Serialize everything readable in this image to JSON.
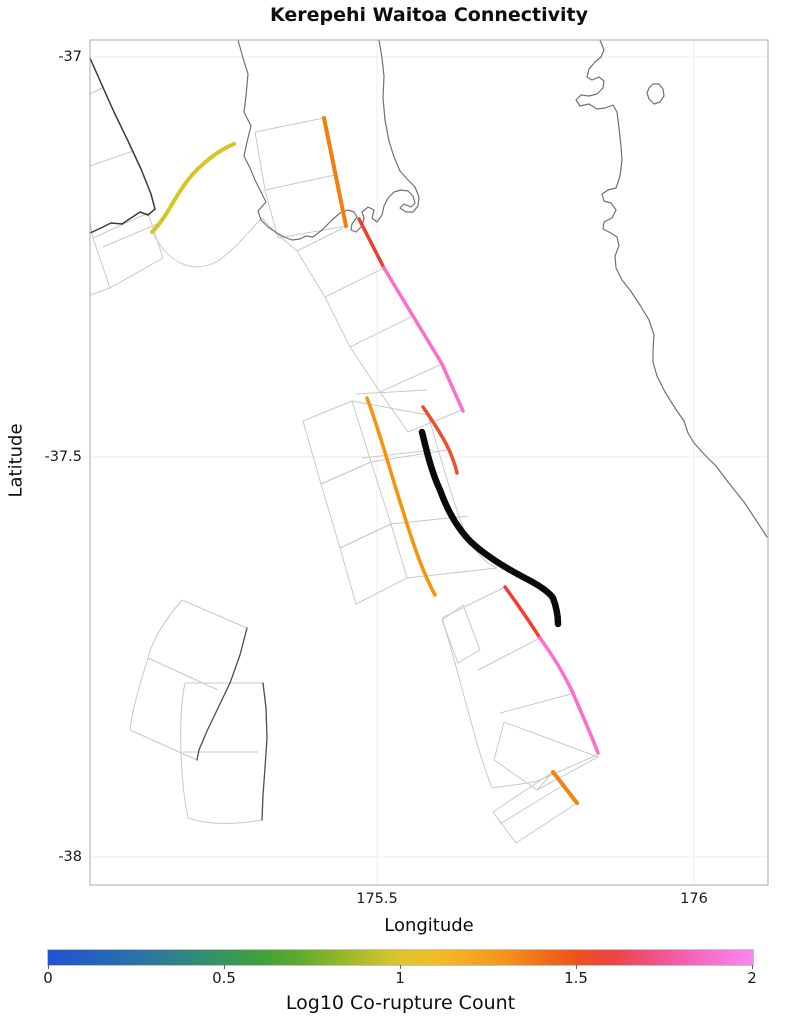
{
  "title": "Kerepehi Waitoa Connectivity",
  "axes": {
    "xlabel": "Longitude",
    "ylabel": "Latitude",
    "x_ticks": [
      {
        "label": "175.5",
        "px": 377
      },
      {
        "label": "176",
        "px": 694
      }
    ],
    "y_ticks": [
      {
        "label": "-37",
        "py": 57
      },
      {
        "label": "-37.5",
        "py": 457
      },
      {
        "label": "-38",
        "py": 857
      }
    ]
  },
  "colorbar": {
    "label": "Log10 Co-rupture Count",
    "range": [
      0,
      2
    ],
    "ticks": [
      {
        "label": "0",
        "pos": "0%"
      },
      {
        "label": "0.5",
        "pos": "25%"
      },
      {
        "label": "1",
        "pos": "50%"
      },
      {
        "label": "1.5",
        "pos": "75%"
      },
      {
        "label": "2",
        "pos": "100%"
      }
    ],
    "gradient": [
      {
        "pos": "0%",
        "color": "#2153d4"
      },
      {
        "pos": "7%",
        "color": "#2563bd"
      },
      {
        "pos": "14%",
        "color": "#2b77a0"
      },
      {
        "pos": "20%",
        "color": "#2f8880"
      },
      {
        "pos": "25%",
        "color": "#35975c"
      },
      {
        "pos": "30%",
        "color": "#3fa03c"
      },
      {
        "pos": "35%",
        "color": "#5aa92e"
      },
      {
        "pos": "40%",
        "color": "#87b32a"
      },
      {
        "pos": "45%",
        "color": "#b3bd2b"
      },
      {
        "pos": "50%",
        "color": "#ddc62e"
      },
      {
        "pos": "55%",
        "color": "#f2bc28"
      },
      {
        "pos": "60%",
        "color": "#f4a822"
      },
      {
        "pos": "65%",
        "color": "#f5921b"
      },
      {
        "pos": "70%",
        "color": "#f07018"
      },
      {
        "pos": "75%",
        "color": "#ec531d"
      },
      {
        "pos": "80%",
        "color": "#ed4342"
      },
      {
        "pos": "85%",
        "color": "#f04f7e"
      },
      {
        "pos": "90%",
        "color": "#f45fae"
      },
      {
        "pos": "95%",
        "color": "#f873d3"
      },
      {
        "pos": "100%",
        "color": "#fb87f2"
      }
    ]
  },
  "chart_data": {
    "type": "map",
    "title": "Kerepehi Waitoa Connectivity",
    "xlabel": "Longitude",
    "ylabel": "Latitude",
    "xlim": [
      175.05,
      176.12
    ],
    "ylim": [
      -38.03,
      -36.98
    ],
    "grid": true,
    "colorbar_label": "Log10 Co-rupture Count",
    "colorbar_range": [
      0,
      2
    ],
    "highlighted_fault": {
      "color": "#0a0a0a",
      "style": "thick black line (target Kerepehi Waitoa section)",
      "start_lonlat": [
        175.571,
        -37.469
      ],
      "end_lonlat": [
        175.786,
        -37.709
      ]
    },
    "fault_traces": [
      {
        "color": "#d6c525",
        "approx_log10_corupture": 1.0,
        "start_lonlat": [
          175.145,
          -37.219
        ],
        "end_lonlat": [
          175.274,
          -37.109
        ]
      },
      {
        "color": "#f57d0e",
        "approx_log10_corupture": 1.3,
        "start_lonlat": [
          175.416,
          -37.076
        ],
        "end_lonlat": [
          175.451,
          -37.211
        ]
      },
      {
        "color": "#f23d28",
        "approx_log10_corupture": 1.55,
        "start_lonlat": [
          175.472,
          -37.203
        ],
        "end_lonlat": [
          175.511,
          -37.264
        ]
      },
      {
        "color": "#fa6fce",
        "approx_log10_corupture": 1.85,
        "start_lonlat": [
          175.511,
          -37.264
        ],
        "end_lonlat": [
          175.636,
          -37.443
        ]
      },
      {
        "color": "#f89307",
        "approx_log10_corupture": 1.25,
        "start_lonlat": [
          175.484,
          -37.426
        ],
        "end_lonlat": [
          175.591,
          -37.673
        ]
      },
      {
        "color": "#ea512b",
        "approx_log10_corupture": 1.5,
        "start_lonlat": [
          175.573,
          -37.438
        ],
        "end_lonlat": [
          175.626,
          -37.52
        ]
      },
      {
        "color": "#f23d30",
        "approx_log10_corupture": 1.55,
        "start_lonlat": [
          175.702,
          -37.663
        ],
        "end_lonlat": [
          175.757,
          -37.726
        ]
      },
      {
        "color": "#fa6fce",
        "approx_log10_corupture": 1.85,
        "start_lonlat": [
          175.757,
          -37.726
        ],
        "end_lonlat": [
          175.849,
          -37.87
        ]
      },
      {
        "color": "#f5820a",
        "approx_log10_corupture": 1.3,
        "start_lonlat": [
          175.778,
          -37.894
        ],
        "end_lonlat": [
          175.815,
          -37.933
        ]
      }
    ],
    "background": "light-gray fault-section polygon mesh, dark-gray unselected fault traces, Firth of Thames / Hauraki coastline"
  },
  "map": {
    "frame": {
      "x": 90,
      "y": 40,
      "w": 678,
      "h": 845
    },
    "frame_color": "#a9a9a9",
    "grid_color": "#ececec",
    "layers": [
      {
        "name": "fault-polygon-mesh",
        "stroke": "#c9c9c9",
        "width": 1,
        "cap": "butt",
        "paths": [
          "M90,94 L104,87",
          "M90,166 L133,151",
          "M90,222 L93,238",
          "M93,238 L148,213 L163,258 L110,288 Z",
          "M103,247 L157,224",
          "M90,295 L110,288",
          "M153,233 C170,268 200,275 222,258 C238,246 250,230 262,218",
          "M262,218 C272,230 284,240 297,251",
          "M255,132 L324,118",
          "M255,132 L265,190 L278,238",
          "M265,190 L335,175",
          "M278,238 L346,226",
          "M297,251 L325,297 L350,347 L380,392 L408,432",
          "M297,251 L343,228",
          "M325,297 L384,268",
          "M350,347 L413,316",
          "M380,392 L442,364",
          "M408,432 L462,410",
          "M303,421 L352,401 L371,462 L321,484 Z",
          "M321,484 L371,462 L391,524 L340,548 Z",
          "M340,548 L391,524 L407,578 L356,604 Z",
          "M352,401 L428,415",
          "M356,394 L427,390",
          "M362,458 L433,450",
          "M428,415 C440,455 452,500 466,535 C475,552 485,563 497,568",
          "M371,462 L447,450",
          "M391,524 L468,516",
          "M407,578 L497,568",
          "M442,620 L463,605 L480,650 L458,663 Z",
          "M442,618 C452,650 462,690 472,725 C478,748 485,770 492,788",
          "M442,618 L503,588",
          "M478,670 L540,638",
          "M500,713 L571,694",
          "M535,782 L597,755",
          "M492,788 L535,782",
          "M504,722 L598,757 L537,790 L494,760 Z",
          "M537,790 L553,772",
          "M493,812 L553,772 L577,803 L516,843 Z",
          "M500,824 L562,786",
          "M182,600 L247,628",
          "M182,600 C165,620 152,640 148,658",
          "M148,658 L218,690",
          "M148,658 C138,690 132,712 130,730",
          "M130,730 L197,760",
          "M185,683 C178,715 180,780 188,818",
          "M185,683 L263,683",
          "M183,752 L258,752",
          "M188,818 C212,826 238,824 262,820"
        ]
      },
      {
        "name": "dark-fault-trace-west",
        "stroke": "#3a3a3a",
        "width": 1.5,
        "cap": "round",
        "paths": [
          "M90,58 L101,83 L114,112 L128,141 L141,169 L151,194 L155,209",
          "M155,209 L148,215 L140,212 L131,218 L122,224 L111,223 L101,228 L90,233"
        ]
      },
      {
        "name": "dark-fault-trace-southwest",
        "stroke": "#4d4d4d",
        "width": 1.3,
        "cap": "round",
        "paths": [
          "M247,628 L240,655 L230,683 L218,708 L207,731 L199,750 L197,760",
          "M263,683 L266,708 L267,738 L265,768 L263,795 L262,820"
        ]
      },
      {
        "name": "coastline",
        "stroke": "#707070",
        "width": 1.2,
        "cap": "round",
        "paths": [
          "M238,40 L243,58 L248,74 L246,96 L244,112 L251,126 L247,142 L244,156 L250,168 L255,180 L261,192 L266,202 L258,211 L261,220 L268,227 L277,233 L284,237 L292,240 L300,239 L306,236 L313,237 L322,230 L331,221 L340,213 L348,210 L354,212 L357,217 L352,224 L351,230 L356,232 L362,226 L364,218 L362,212 L368,207 L374,210 L372,218 L377,222 L382,215 L384,206 L388,198 L394,192 L401,190 L408,191 L413,196 L415,203 L411,207 L404,204 L400,208 L406,212 L413,212 L418,206 L419,197 L415,187 L408,180 L400,171 L394,157 L389,141 L385,120 L383,98 L384,76 L382,58 L379,40",
          "M600,40 L604,50 L601,57 L595,62 L589,69 L587,77 L592,80 L599,77 L604,81 L603,88 L597,94 L589,96 L581,95 L576,100 L580,106 L589,104 L597,109 L605,108 L613,105 L617,112 L619,128 L621,146 L622,160 L620,176 L616,188 L608,190 L602,194 L604,201 L611,203 L616,210 L612,218 L604,222 L603,229 L611,233 L617,237 L619,246 L615,256 L616,268 L622,280 L630,290 L640,305 L649,320 L654,335 L653,350 L653,362 L657,376 L665,392 L675,408 L684,421 L688,433 L694,443 L704,454 L716,466 L728,482 L744,502 L756,520 L767,537",
          "M649,88 L653,84 L659,84 L663,89 L664,96 L660,102 L654,104 L649,99 L647,93 Z"
        ]
      },
      {
        "name": "trace-yellow",
        "stroke": "#d6c525",
        "width": 4,
        "cap": "round",
        "paths": [
          "M152,232 C158,226 164,218 171,206 C179,192 189,176 201,166 C213,155 224,148 234,144"
        ]
      },
      {
        "name": "trace-orange-north",
        "stroke": "#f57d0e",
        "width": 4,
        "cap": "round",
        "paths": [
          "M324,118 L346,226"
        ]
      },
      {
        "name": "trace-red-north",
        "stroke": "#f23d28",
        "width": 3.5,
        "cap": "round",
        "paths": [
          "M359,219 L384,268"
        ]
      },
      {
        "name": "trace-pink-north",
        "stroke": "#fa6fce",
        "width": 3.5,
        "cap": "round",
        "paths": [
          "M384,268 L413,316 L442,364 L463,411"
        ]
      },
      {
        "name": "trace-orange-mid",
        "stroke": "#f89307",
        "width": 3.5,
        "cap": "round",
        "paths": [
          "M367,398 C380,432 392,478 403,511 C412,541 424,575 435,595"
        ]
      },
      {
        "name": "trace-redorange-mid",
        "stroke": "#ea512b",
        "width": 3.5,
        "cap": "round",
        "paths": [
          "M423,407 C432,420 444,438 450,452 C454,462 456,468 457,473"
        ]
      },
      {
        "name": "trace-black-waitoa",
        "stroke": "#0a0a0a",
        "width": 6.5,
        "cap": "round",
        "paths": [
          "M422,432 C426,448 431,471 440,490 C448,512 459,530 471,542 C486,556 506,568 523,577 C539,585 549,592 553,598 C556,606 558,614 558,624"
        ]
      },
      {
        "name": "trace-red-south",
        "stroke": "#f23d30",
        "width": 3.5,
        "cap": "round",
        "paths": [
          "M505,587 C516,602 529,621 540,638"
        ]
      },
      {
        "name": "trace-pink-south",
        "stroke": "#fa6fce",
        "width": 3.5,
        "cap": "round",
        "paths": [
          "M540,638 C551,653 562,670 572,691 C581,712 591,734 598,753"
        ]
      },
      {
        "name": "trace-orange-south",
        "stroke": "#f5820a",
        "width": 4,
        "cap": "round",
        "paths": [
          "M553,772 L577,803"
        ]
      }
    ]
  }
}
